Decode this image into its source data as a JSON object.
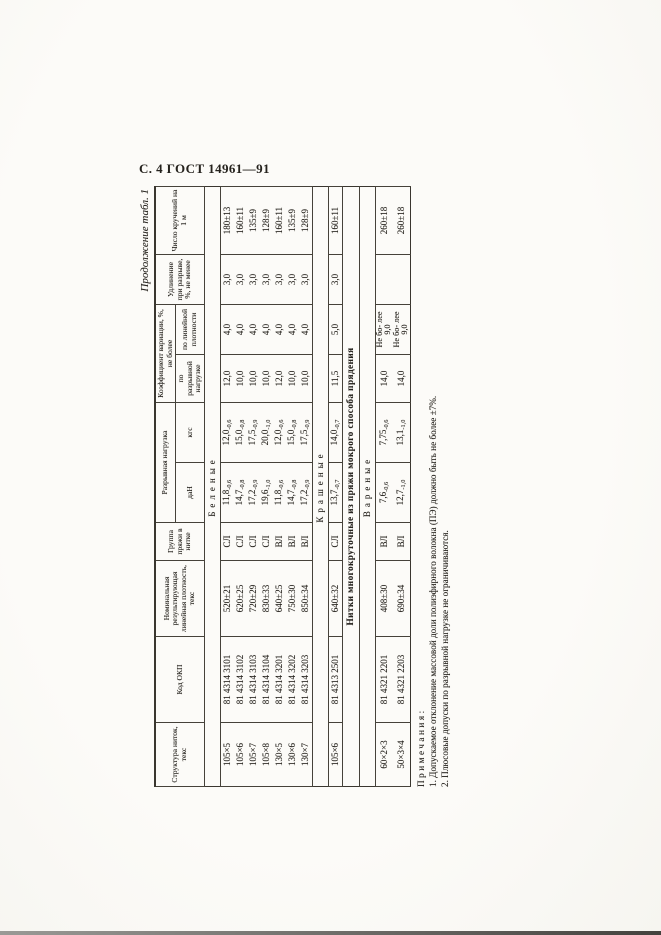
{
  "page": {
    "header": "С. 4 ГОСТ 14961—91",
    "continuation": "Продолжение табл. 1"
  },
  "colors": {
    "paper": "#fbfaf6",
    "ink": "#25221d"
  },
  "table": {
    "headers": {
      "structure": "Структура ниток, текс",
      "okp": "Код ОКП",
      "nominal": "Номинальная результирующая линейная плотность, текс",
      "group": "Группа пряжи в нитке",
      "breaking_load": "Разрывная нагрузка",
      "dan": "даН",
      "kgs": "кгс",
      "cv": "Коэффициент вариации, %, не более",
      "cv_load": "по разрывной нагрузке",
      "cv_density": "по линейной плотности",
      "elongation": "Удлинение при разрыве, %, не менее",
      "twists": "Число кручений на 1 м"
    },
    "sections": [
      {
        "type": "group",
        "label": "Беленые"
      },
      {
        "type": "rows",
        "rows": [
          {
            "structure": "105×5",
            "okp": "81 4314 3101",
            "nominal": "520±21",
            "group": "СЛ",
            "dan": "11,8",
            "dan_tol": "-0,6",
            "kgs": "12,0",
            "kgs_tol": "-0,6",
            "cv_load": "12,0",
            "cv_density": "4,0",
            "elongation": "3,0",
            "twists": "180±13"
          },
          {
            "structure": "105×6",
            "okp": "81 4314 3102",
            "nominal": "620±25",
            "group": "СЛ",
            "dan": "14,7",
            "dan_tol": "-0,8",
            "kgs": "15,0",
            "kgs_tol": "-0,8",
            "cv_load": "10,0",
            "cv_density": "4,0",
            "elongation": "3,0",
            "twists": "160±11"
          },
          {
            "structure": "105×7",
            "okp": "81 4314 3103",
            "nominal": "720±29",
            "group": "СЛ",
            "dan": "17,2",
            "dan_tol": "-0,9",
            "kgs": "17,5",
            "kgs_tol": "-0,9",
            "cv_load": "10,0",
            "cv_density": "4,0",
            "elongation": "3,0",
            "twists": "135±9"
          },
          {
            "structure": "105×8",
            "okp": "81 4314 3104",
            "nominal": "830±33",
            "group": "СЛ",
            "dan": "19,6",
            "dan_tol": "-1,0",
            "kgs": "20,0",
            "kgs_tol": "-1,0",
            "cv_load": "10,0",
            "cv_density": "4,0",
            "elongation": "3,0",
            "twists": "128±9"
          },
          {
            "structure": "130×5",
            "okp": "81 4314 3201",
            "nominal": "640±25",
            "group": "ВЛ",
            "dan": "11,8",
            "dan_tol": "-0,6",
            "kgs": "12,0",
            "kgs_tol": "-0,6",
            "cv_load": "12,0",
            "cv_density": "4,0",
            "elongation": "3,0",
            "twists": "160±11"
          },
          {
            "structure": "130×6",
            "okp": "81 4314 3202",
            "nominal": "750±30",
            "group": "ВЛ",
            "dan": "14,7",
            "dan_tol": "-0,8",
            "kgs": "15,0",
            "kgs_tol": "-0,8",
            "cv_load": "10,0",
            "cv_density": "4,0",
            "elongation": "3,0",
            "twists": "135±9"
          },
          {
            "structure": "130×7",
            "okp": "81 4314 3203",
            "nominal": "850±34",
            "group": "ВЛ",
            "dan": "17,2",
            "dan_tol": "-0,9",
            "kgs": "17,5",
            "kgs_tol": "-0,9",
            "cv_load": "10,0",
            "cv_density": "4,0",
            "elongation": "3,0",
            "twists": "128±9"
          }
        ]
      },
      {
        "type": "group",
        "label": "Крашеные"
      },
      {
        "type": "rows",
        "rows": [
          {
            "structure": "105×6",
            "okp": "81 4313 2501",
            "nominal": "640±32",
            "group": "СЛ",
            "dan": "13,7",
            "dan_tol": "-0,7",
            "kgs": "14,0",
            "kgs_tol": "-0,7",
            "cv_load": "11,5",
            "cv_density": "5,0",
            "elongation": "3,0",
            "twists": "160±11"
          }
        ]
      },
      {
        "type": "section",
        "label": "Нитки многокруточные из пряжи мокрого способа прядения"
      },
      {
        "type": "group",
        "label": "Вареные"
      },
      {
        "type": "rows",
        "rows": [
          {
            "structure": "60×2×3",
            "okp": "81 4321 2201",
            "nominal": "408±30",
            "group": "ВЛ",
            "dan": "7,6",
            "dan_tol": "-0,6",
            "kgs": "7,75",
            "kgs_tol": "-0,6",
            "cv_load": "14,0",
            "cv_density": "Не бо- лее 9,0",
            "elongation": "",
            "twists": "260±18"
          },
          {
            "structure": "50×3×4",
            "okp": "81 4321 2203",
            "nominal": "690±34",
            "group": "ВЛ",
            "dan": "12,7",
            "dan_tol": "-1,0",
            "kgs": "13,1",
            "kgs_tol": "-1,0",
            "cv_load": "14,0",
            "cv_density": "Не бо- лее 9,0",
            "elongation": "",
            "twists": "260±18"
          }
        ]
      }
    ]
  },
  "notes": {
    "label": "Примечания:",
    "items": [
      {
        "num": "1.",
        "text": "Допускаемое отклонение массовой доли полиэфирного волокна (ПЭ) должно быть не более ±7%."
      },
      {
        "num": "2.",
        "text": "Плюсовые допуски по разрывной нагрузке не ограничиваются."
      }
    ]
  }
}
